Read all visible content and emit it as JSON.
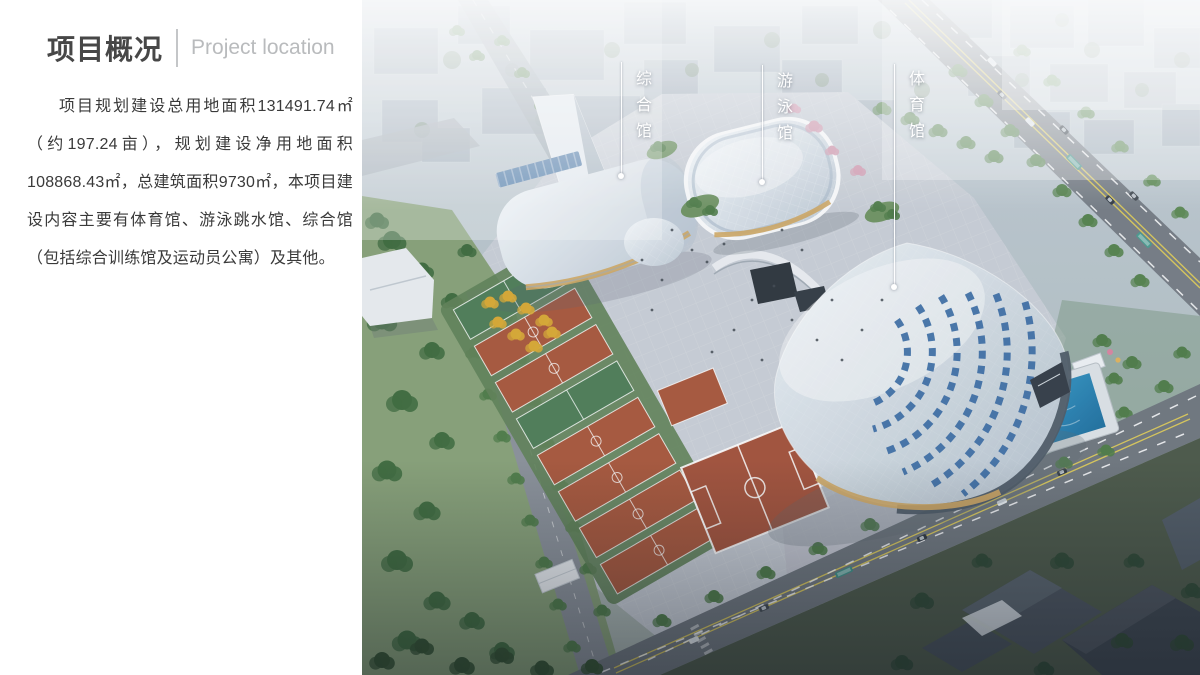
{
  "slide": {
    "title_zh": "项目概况",
    "title_en": "Project location",
    "paragraph": "项目规划建设总用地面积131491.74㎡（约197.24亩），规划建设净用地面积108868.43㎡，总建筑面积9730㎡，本项目建设内容主要有体育馆、游泳跳水馆、综合馆（包括综合训练馆及运动员公寓）及其他。"
  },
  "photo": {
    "callouts": [
      {
        "id": "comprehensive-hall",
        "text": "综合馆"
      },
      {
        "id": "swimming-hall",
        "text": "游泳馆"
      },
      {
        "id": "stadium",
        "text": "体育馆"
      }
    ],
    "palette": {
      "court_red": "#a8573c",
      "field_red": "#a3523a",
      "pool_blue": "#2d8fc4",
      "roof_tile_blue": "#3a6ba3",
      "facade_gold": "#cfa763",
      "tree_green": "#4f7c48",
      "plaza_gray": "#c9ced6"
    }
  }
}
